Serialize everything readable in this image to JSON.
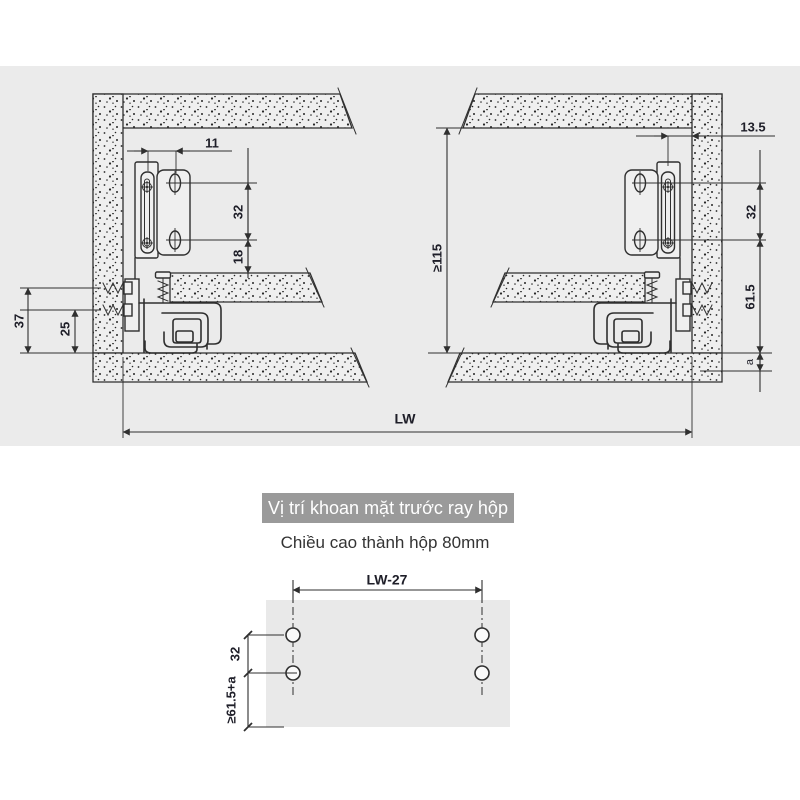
{
  "colors": {
    "page_bg": "#ffffff",
    "band_bg": "#ebebeb",
    "line": "#2f2f2f",
    "label": "#1e1e28",
    "panel_fill": "#efefef",
    "title_bg": "#9a9a9a",
    "title_text": "#ffffff",
    "subtitle_text": "#333333",
    "drill_panel": "#e9e9e9"
  },
  "cross_section": {
    "left_view": {
      "dim_front_offset": "11",
      "dim_hole_pitch": "32",
      "dim_flange": "18",
      "dim_screw_top": "37",
      "dim_screw_bottom": "25"
    },
    "right_view": {
      "dim_front_gap": "13.5",
      "dim_interior_height": "≥115",
      "dim_hole_pitch": "32",
      "dim_bottom": "61.5",
      "dim_gap": "a"
    },
    "dim_cabinet_width": "LW"
  },
  "drill_section": {
    "title": "Vị trí khoan mặt trước ray hộp",
    "subtitle": "Chiều cao thành hộp 80mm",
    "dim_width": "LW-27",
    "dim_hole_pitch": "32",
    "dim_bottom": "≥61.5+a"
  }
}
